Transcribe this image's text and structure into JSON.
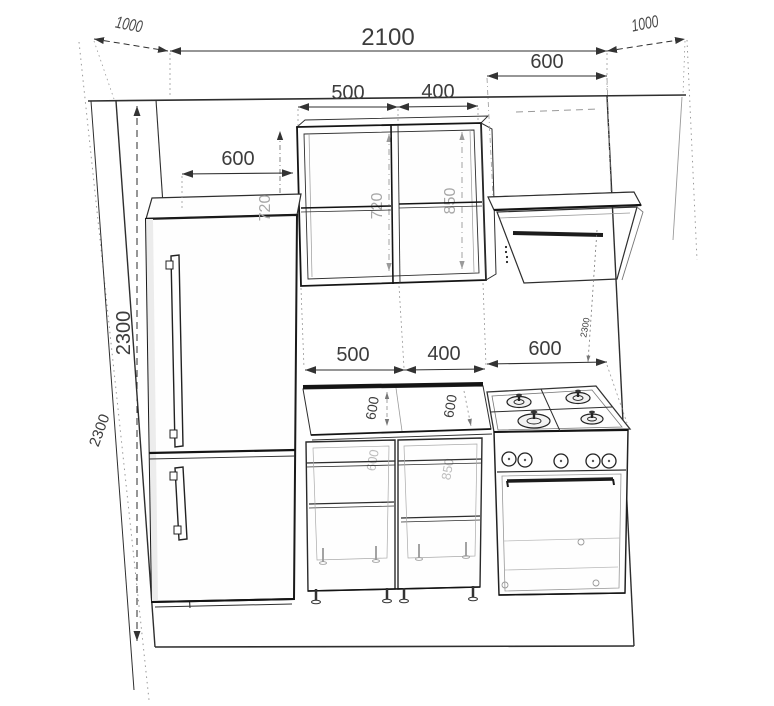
{
  "dims": {
    "room_width": "2100",
    "side_depth_left": "1000",
    "side_depth_right": "1000",
    "hood_width": "600",
    "wall_cabinet_left_width": "500",
    "wall_cabinet_right_width": "400",
    "fridge_width": "600",
    "fridge_height": "2300",
    "wall_height_left": "2300",
    "wall_height_right": "2300",
    "wall_cabinet_left_height": "720",
    "wall_cabinet_edge_height": "720",
    "wall_cabinet_right_height": "850",
    "base_left_width": "500",
    "base_right_width": "400",
    "stove_width": "600",
    "counter_depth_left": "600",
    "counter_depth_right": "600",
    "base_left_label": "600",
    "base_right_label": "850"
  },
  "colors": {
    "background": "#ffffff",
    "line": "#2e2e2e",
    "heavy_line": "#141414",
    "dim_text": "#3d3d3d",
    "gray_label": "#a8a8a8"
  }
}
